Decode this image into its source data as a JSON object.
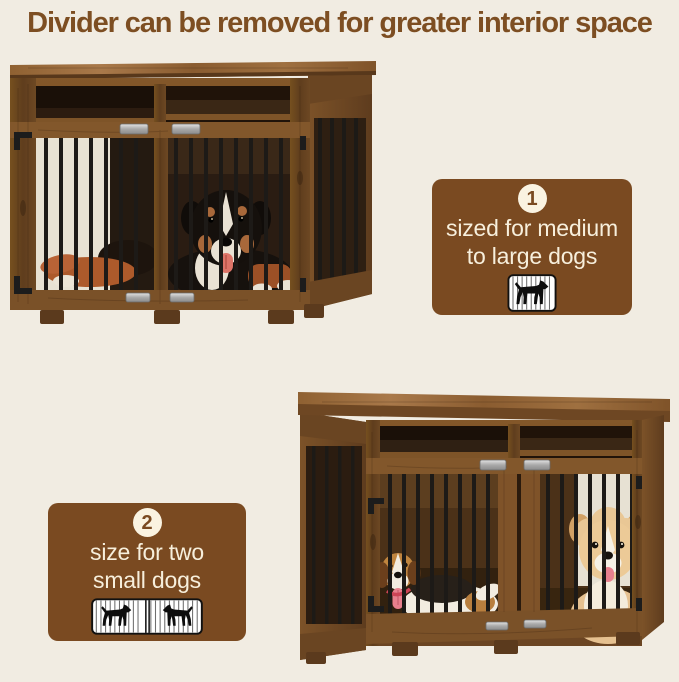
{
  "page": {
    "title": "Divider can be removed for greater interior space"
  },
  "colors": {
    "background": "#f1ece2",
    "title_text": "#7d4e22",
    "badge_background": "#7a4a21",
    "badge_text": "#f7efdc",
    "badge_number_circle": "#faf3e1",
    "crate_wood": "#7f5329",
    "cage_bars": "#1d1a17"
  },
  "badges": [
    {
      "number": "1",
      "line1": "sized for medium",
      "line2": "to large dogs",
      "icon": "single-dog-crate-icon"
    },
    {
      "number": "2",
      "line1": "size for two",
      "line2": "small dogs",
      "icon": "two-small-dogs-crate-icon"
    }
  ],
  "photos": [
    {
      "name": "crate-with-large-dog"
    },
    {
      "name": "crate-with-two-small-dogs"
    }
  ]
}
